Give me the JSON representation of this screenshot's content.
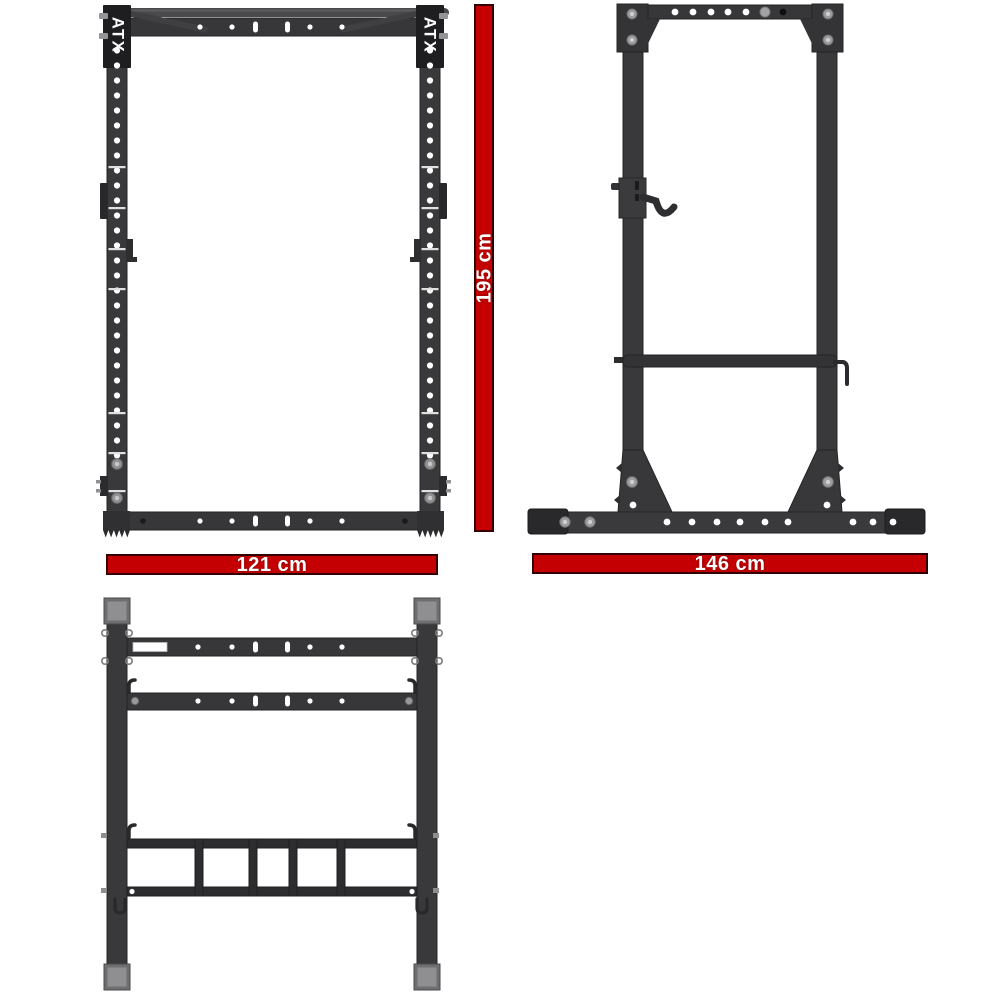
{
  "brand": "ATX",
  "views": {
    "front": {
      "brand_badge_left": "ATX",
      "brand_badge_right": "ATX"
    }
  },
  "dimensions": {
    "height_label": "195 cm",
    "width_label": "121 cm",
    "depth_label": "146 cm"
  },
  "colors": {
    "background": "#ffffff",
    "dimension_bar": "#c50002",
    "dimension_bar_border": "#330000",
    "dimension_text": "#ffffff",
    "frame": "#38383b",
    "frame_dark": "#29292c",
    "cap_gray": "#8f8f92",
    "hole": "#ffffff"
  }
}
